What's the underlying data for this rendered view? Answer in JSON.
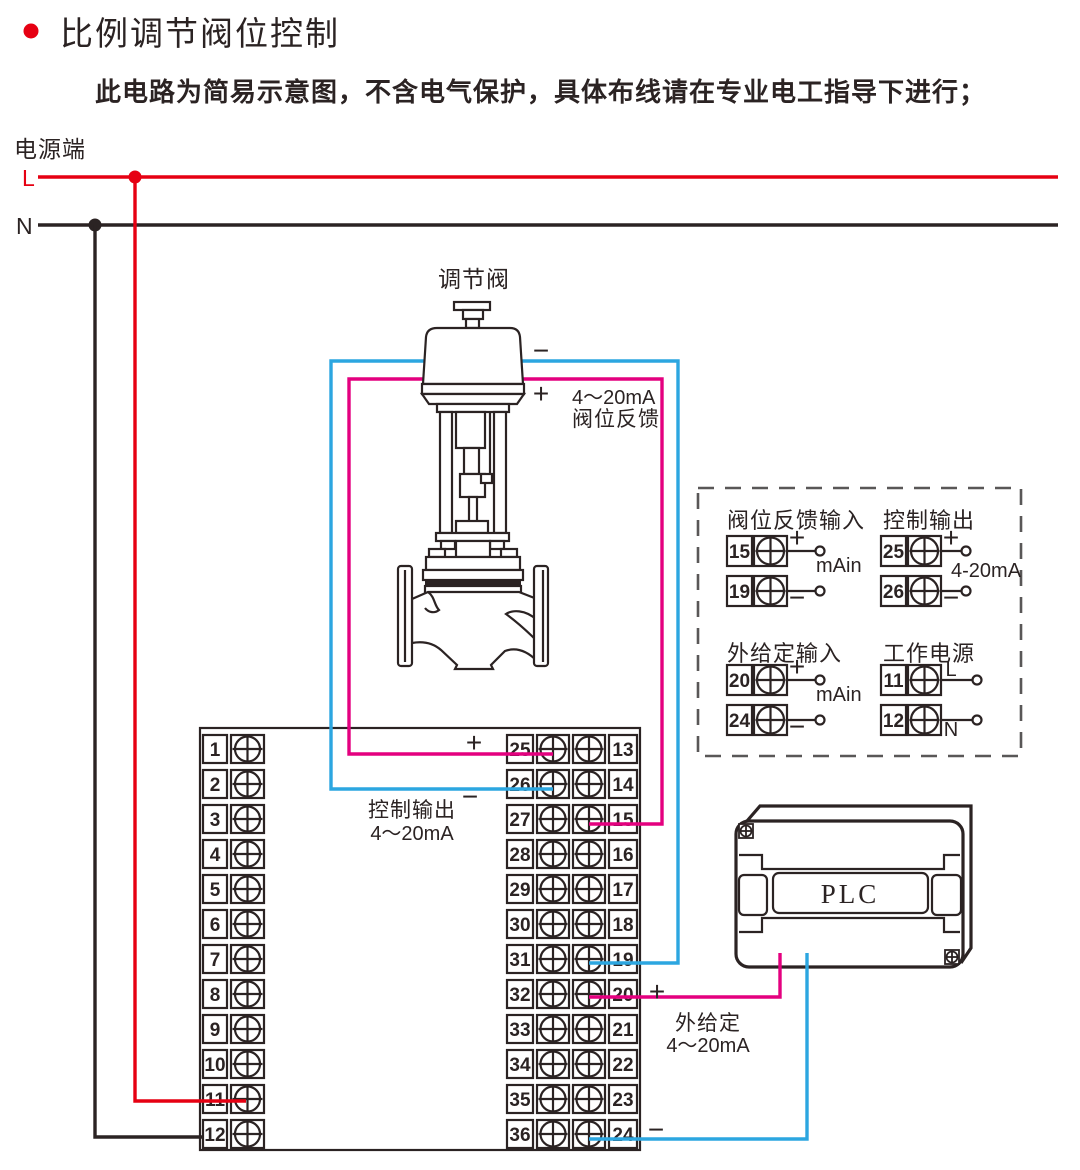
{
  "colors": {
    "ink": "#2b2323",
    "red": "#e60012",
    "magenta": "#e4007f",
    "blue": "#2ca6e0",
    "gray": "#595757"
  },
  "header": {
    "title": "比例调节阀位控制",
    "subtitle": "此电路为简易示意图，不含电气保护，具体布线请在专业电工指导下进行；"
  },
  "power": {
    "label": "电源端",
    "line_live": "L",
    "line_neutral": "N"
  },
  "signs": {
    "plus": "+",
    "minus": "−"
  },
  "valve": {
    "label": "调节阀",
    "feedback_note_line1": "4～20mA",
    "feedback_note_line2": "阀位反馈"
  },
  "controller": {
    "left_numbers": [
      "1",
      "2",
      "3",
      "4",
      "5",
      "6",
      "7",
      "8",
      "9",
      "10",
      "11",
      "12"
    ],
    "mid_left_numbers": [
      "25",
      "26",
      "27",
      "28",
      "29",
      "30",
      "31",
      "32",
      "33",
      "34",
      "35",
      "36"
    ],
    "mid_right_numbers": [
      "13",
      "14",
      "15",
      "16",
      "17",
      "18",
      "19",
      "20",
      "21",
      "22",
      "23",
      "24"
    ],
    "control_output_note_line1": "控制输出",
    "control_output_note_line2": "4～20mA"
  },
  "setpoint_note": {
    "line1": "外给定",
    "line2": "4～20mA"
  },
  "panel": {
    "groups": [
      {
        "title": "阀位反馈输入",
        "range": "mAin",
        "terminals": [
          {
            "no": "15",
            "sign": "+"
          },
          {
            "no": "19",
            "sign": "−"
          }
        ]
      },
      {
        "title": "控制输出",
        "range": "4-20mA",
        "terminals": [
          {
            "no": "25",
            "sign": "+"
          },
          {
            "no": "26",
            "sign": "−"
          }
        ]
      },
      {
        "title": "外给定输入",
        "range": "mAin",
        "terminals": [
          {
            "no": "20",
            "sign": "+"
          },
          {
            "no": "24",
            "sign": "−"
          }
        ]
      },
      {
        "title": "工作电源",
        "range": "",
        "terminals": [
          {
            "no": "11",
            "sign": "L"
          },
          {
            "no": "12",
            "sign": "N"
          }
        ]
      }
    ]
  },
  "plc": {
    "label": "PLC"
  }
}
